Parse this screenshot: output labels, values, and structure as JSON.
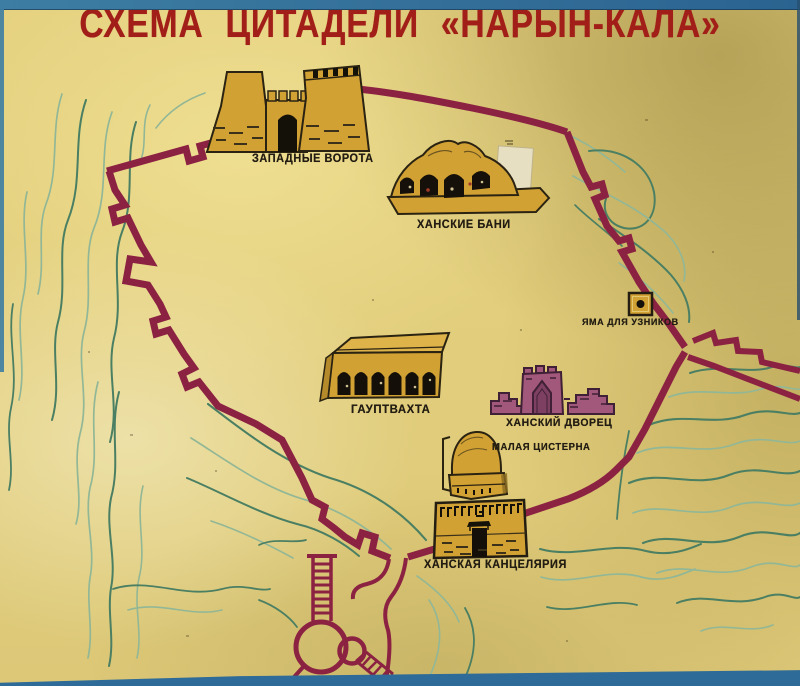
{
  "poster": {
    "title": "СХЕМА ЦИТАДЕЛИ «НАРЫН-КАЛА»"
  },
  "map": {
    "buildings": [
      {
        "id": "western-gate",
        "label": "ЗАПАДНЫЕ ВОРОТА"
      },
      {
        "id": "khan-baths",
        "label": "ХАНСКИЕ БАНИ"
      },
      {
        "id": "prisoner-pit",
        "label": "ЯМА ДЛЯ УЗНИКОВ"
      },
      {
        "id": "guardhouse",
        "label": "ГАУПТВАХТА"
      },
      {
        "id": "khan-palace",
        "label": "ХАНСКИЙ ДВОРЕЦ"
      },
      {
        "id": "small-cistern",
        "label": "МАЛАЯ ЦИСТЕРНА"
      },
      {
        "id": "khan-chancellery",
        "label": "ХАНСКАЯ КАНЦЕЛЯРИЯ"
      }
    ]
  },
  "colors": {
    "title_red": "#a21e18",
    "wall_maroon": "#8b2242",
    "building_gold": "#d2a134",
    "palace_plum": "#a2587a",
    "contour_teal_dark": "#4b7f63",
    "contour_teal_light": "#92b796",
    "paper_yellow": "#e1cd7b",
    "photo_border_blue": "#2e6b98",
    "label_ink": "#221c12"
  }
}
